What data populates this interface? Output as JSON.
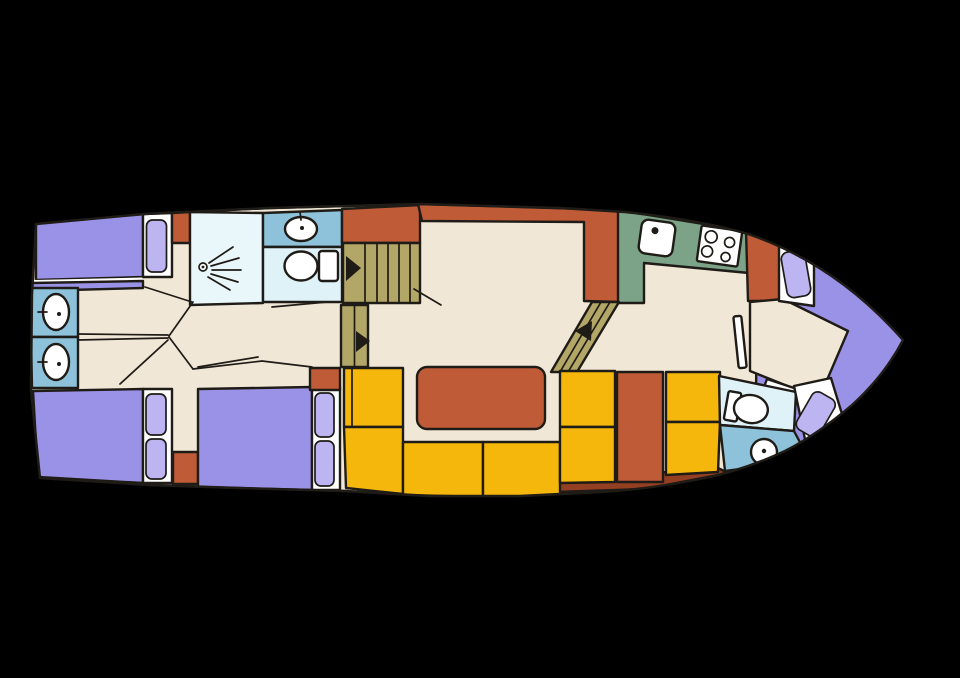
{
  "colors": {
    "background": "#000000",
    "floor": "#f1e7d6",
    "bed": "#9a92e6",
    "pillow": "#bdb5f2",
    "terracotta": "#c05b38",
    "dark_strip": "#953f22",
    "seat_yellow": "#f6b70d",
    "stair_khaki": "#b3a768",
    "counter_green": "#7ca287",
    "bath_blue_medium": "#8dc2da",
    "bath_blue_pale": "#dff2f8",
    "shower_pale": "#e9f6fa",
    "fixture_white": "#ffffff"
  },
  "legend": {
    "vessel": "motor-yacht-deck-plan",
    "areas": [
      "aft-cabin-port-bed",
      "aft-cabin-starboard-beds",
      "aft-vanity-sinks",
      "shower-room",
      "aft-bathroom-toilet-sink",
      "companionway-stairs",
      "saloon-dinette-yellow-seating",
      "saloon-table",
      "galley-sink-stove",
      "bow-bathroom-toilet-sink",
      "bow-v-berth"
    ]
  }
}
